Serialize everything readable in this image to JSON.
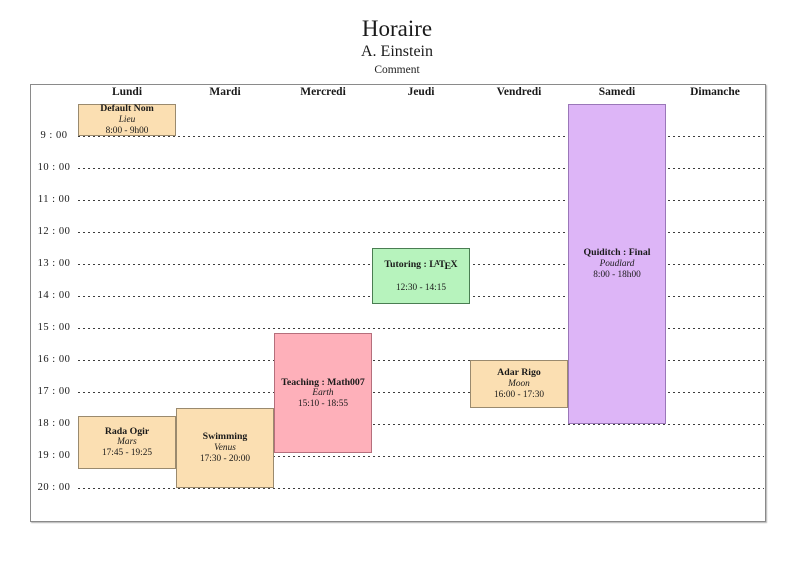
{
  "header": {
    "title": "Horaire",
    "subtitle": "A. Einstein",
    "comment": "Comment"
  },
  "days": [
    "Lundi",
    "Mardi",
    "Mercredi",
    "Jeudi",
    "Vendredi",
    "Samedi",
    "Dimanche"
  ],
  "hour_labels": [
    "9 : 00",
    "10 : 00",
    "11 : 00",
    "12 : 00",
    "13 : 00",
    "14 : 00",
    "15 : 00",
    "16 : 00",
    "17 : 00",
    "18 : 00",
    "19 : 00",
    "20 : 00"
  ],
  "hour_values": [
    9,
    10,
    11,
    12,
    13,
    14,
    15,
    16,
    17,
    18,
    19,
    20
  ],
  "palette": {
    "peach": {
      "fill": "#fbdfb2",
      "border": "#9a8a6e"
    },
    "pink": {
      "fill": "#feb0ba",
      "border": "#b56f7c"
    },
    "green": {
      "fill": "#b7f3bd",
      "border": "#4a7d52"
    },
    "purple": {
      "fill": "#ddb5f7",
      "border": "#9a77b8"
    }
  },
  "latex_logo_letters": [
    "L",
    "A",
    "T",
    "E",
    "X"
  ],
  "events": [
    {
      "day": "Lundi",
      "day_index": 0,
      "start_h": 8.0,
      "end_h": 9.0,
      "title": "Default Nom",
      "location": "Lieu",
      "time_label": "8:00 - 9h00",
      "color": "peach",
      "latex_logo": false
    },
    {
      "day": "Lundi",
      "day_index": 0,
      "start_h": 17.75,
      "end_h": 19.417,
      "title": "Rada Ogir",
      "location": "Mars",
      "time_label": "17:45 - 19:25",
      "color": "peach",
      "latex_logo": false
    },
    {
      "day": "Mardi",
      "day_index": 1,
      "start_h": 17.5,
      "end_h": 20.0,
      "title": "Swimming",
      "location": "Venus",
      "time_label": "17:30 - 20:00",
      "color": "peach",
      "latex_logo": false
    },
    {
      "day": "Mercredi",
      "day_index": 2,
      "start_h": 15.167,
      "end_h": 18.917,
      "title": "Teaching : Math007",
      "location": "Earth",
      "time_label": "15:10 - 18:55",
      "color": "pink",
      "latex_logo": false
    },
    {
      "day": "Jeudi",
      "day_index": 3,
      "start_h": 12.5,
      "end_h": 14.25,
      "title": "Tutoring : LaTeX",
      "title_prefix": "Tutoring : ",
      "location": "",
      "time_label": "12:30 - 14:15",
      "color": "green",
      "latex_logo": true
    },
    {
      "day": "Vendredi",
      "day_index": 4,
      "start_h": 16.0,
      "end_h": 17.5,
      "title": "Adar Rigo",
      "location": "Moon",
      "time_label": "16:00 - 17:30",
      "color": "peach",
      "latex_logo": false
    },
    {
      "day": "Samedi",
      "day_index": 5,
      "start_h": 8.0,
      "end_h": 18.0,
      "title": "Quiditch : Final",
      "location": "Poudlard",
      "time_label": "8:00 - 18h00",
      "color": "purple",
      "latex_logo": false
    }
  ]
}
